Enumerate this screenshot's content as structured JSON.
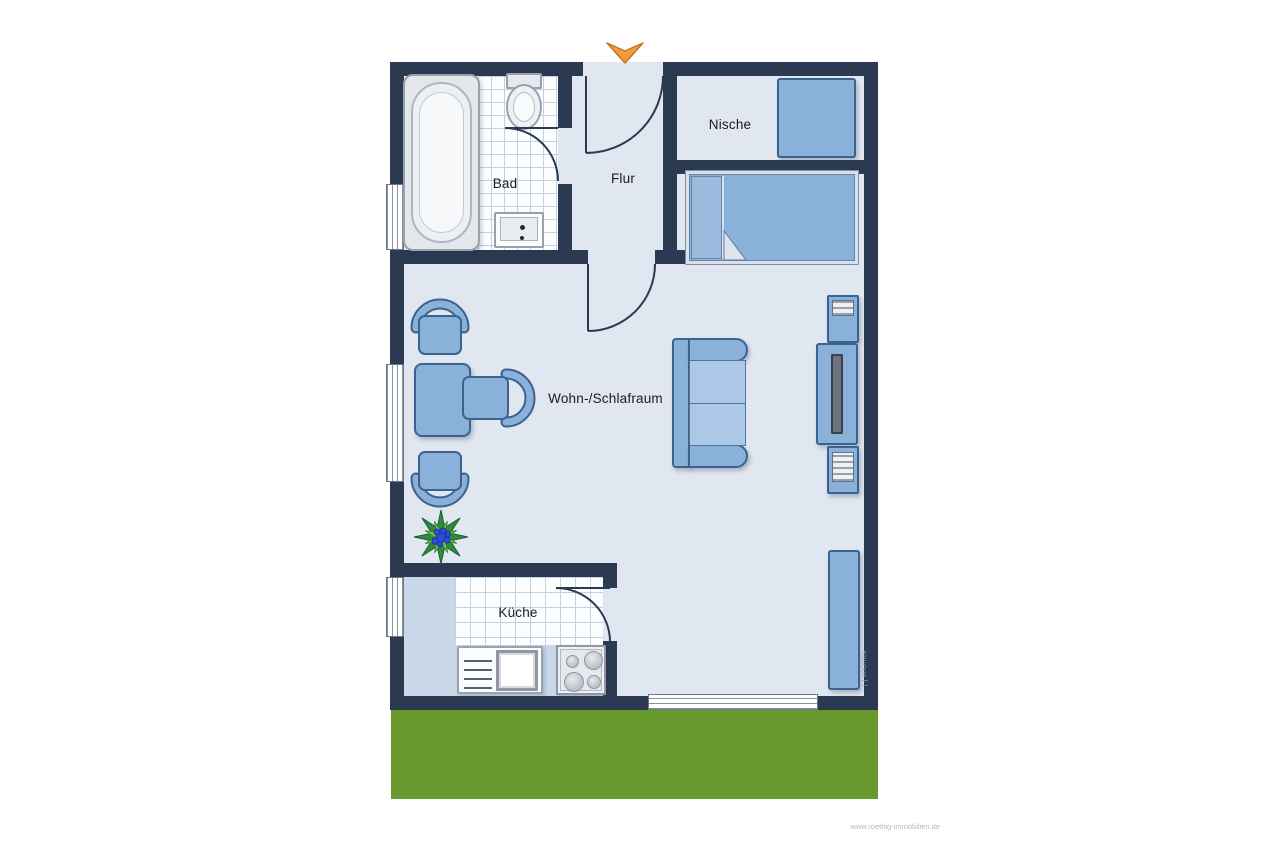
{
  "colors": {
    "wall": "#2b3a50",
    "floor": "#e1e7f0",
    "floor-kitchen": "#c9d7e8",
    "tile": "#fcfdff",
    "tile-line": "#bed2e4",
    "furn": "#8ab1d9",
    "furn-border": "#3c628f",
    "cushion": "#adc8e6",
    "lawn": "#67992e",
    "arrow": "#f49b3d",
    "arrow-border": "#c27722",
    "plant-dark": "#2f8c3e",
    "plant-light": "#7cc143",
    "plant-flower": "#2b4ddb"
  },
  "rooms": {
    "bad": "Bad",
    "flur": "Flur",
    "nische": "Nische",
    "wohnschlafraum": "Wohn-/Schlafraum",
    "kueche": "Küche"
  },
  "watermarks": {
    "software": "[ ] onOffice",
    "website": "www.roethig-immobilien.de"
  }
}
